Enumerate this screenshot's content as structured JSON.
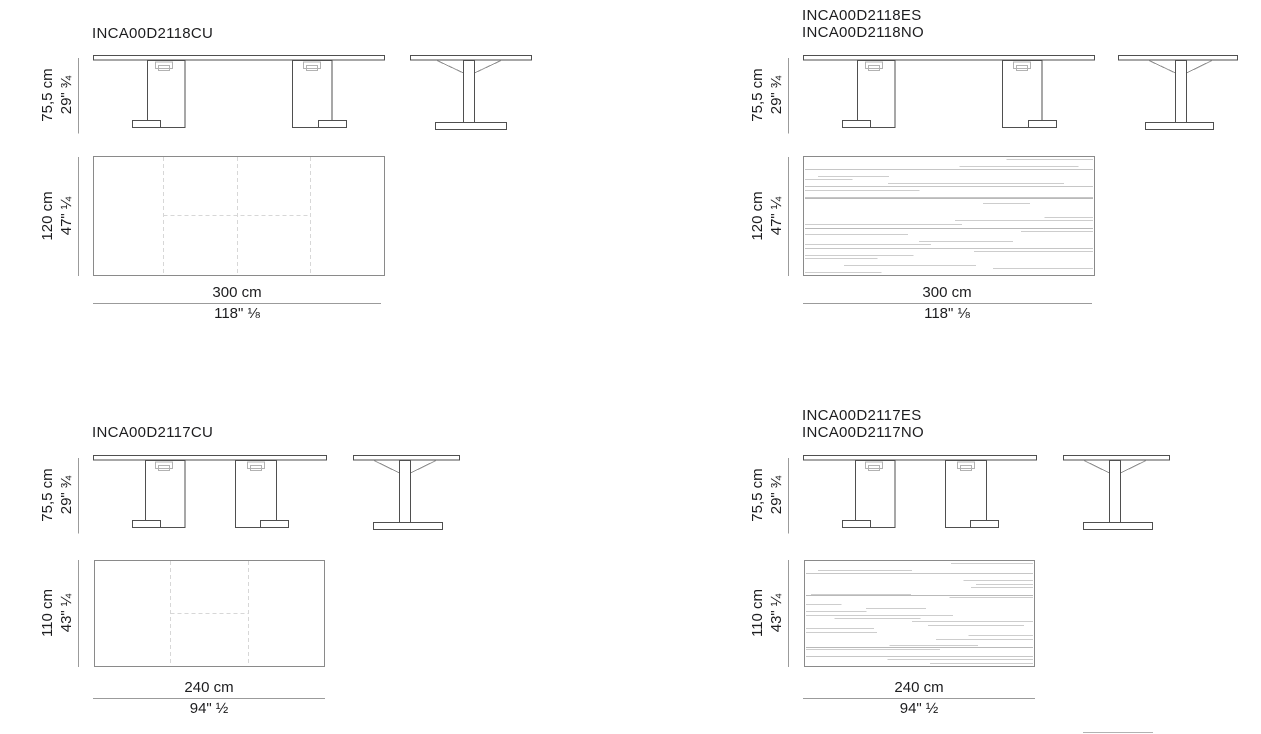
{
  "page": {
    "background": "#ffffff",
    "line_color": "#4f4f4f",
    "dim_line_color": "#9b9b9b",
    "dashed_line_color": "#d7d7d7",
    "grain_color": "#cdcdcd"
  },
  "products": [
    {
      "panel": "top-left",
      "codes": [
        "INCA00D2118CU"
      ],
      "height": {
        "cm": "75,5 cm",
        "in": "29\"",
        "frac": "¾"
      },
      "depth": {
        "cm": "120 cm",
        "in": "47\"",
        "frac": "¼"
      },
      "length": {
        "cm": "300 cm",
        "in": "118\"",
        "frac": "⅛"
      },
      "top_finish": "plain-with-extension-seams"
    },
    {
      "panel": "top-right",
      "codes": [
        "INCA00D2118ES",
        "INCA00D2118NO"
      ],
      "height": {
        "cm": "75,5 cm",
        "in": "29\"",
        "frac": "¾"
      },
      "depth": {
        "cm": "120 cm",
        "in": "47\"",
        "frac": "¼"
      },
      "length": {
        "cm": "300 cm",
        "in": "118\"",
        "frac": "⅛"
      },
      "top_finish": "wood-grain"
    },
    {
      "panel": "bottom-left",
      "codes": [
        "INCA00D2117CU"
      ],
      "height": {
        "cm": "75,5 cm",
        "in": "29\"",
        "frac": "¾"
      },
      "depth": {
        "cm": "110 cm",
        "in": "43\"",
        "frac": "¼"
      },
      "length": {
        "cm": "240 cm",
        "in": "94\"",
        "frac": "½"
      },
      "top_finish": "plain-with-extension-seams"
    },
    {
      "panel": "bottom-right",
      "codes": [
        "INCA00D2117ES",
        "INCA00D2117NO"
      ],
      "height": {
        "cm": "75,5 cm",
        "in": "29\"",
        "frac": "¾"
      },
      "depth": {
        "cm": "110 cm",
        "in": "43\"",
        "frac": "¼"
      },
      "length": {
        "cm": "240 cm",
        "in": "94\"",
        "frac": "½"
      },
      "top_finish": "wood-grain"
    }
  ]
}
